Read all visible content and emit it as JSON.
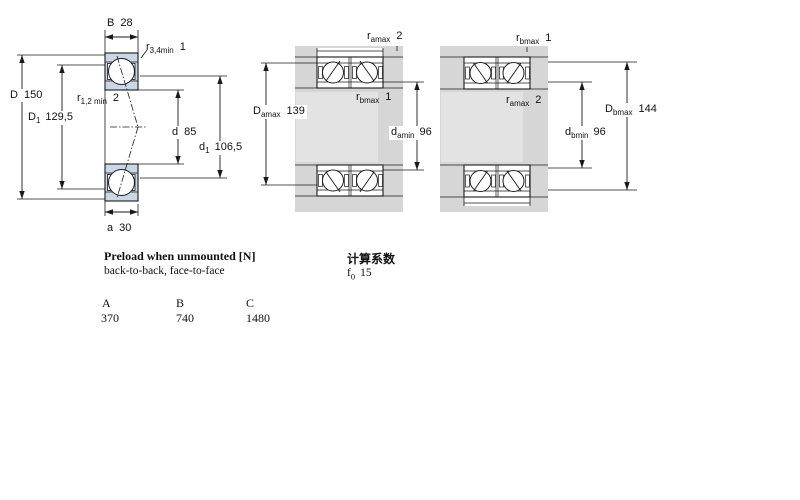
{
  "diagrams": {
    "left": {
      "labels": {
        "B": {
          "sym": "B",
          "val": "28"
        },
        "r34": {
          "sym": "r",
          "sub": "3,4min",
          "val": "1"
        },
        "D": {
          "sym": "D",
          "val": "150"
        },
        "D1": {
          "sym": "D",
          "sub": "1",
          "val": "129,5"
        },
        "r12": {
          "sym": "r",
          "sub": "1,2 min",
          "val": "2"
        },
        "d": {
          "sym": "d",
          "val": "85"
        },
        "d1": {
          "sym": "d",
          "sub": "1",
          "val": "106,5"
        },
        "a": {
          "sym": "a",
          "val": "30"
        }
      }
    },
    "middle": {
      "labels": {
        "ramax": {
          "sym": "r",
          "sub": "amax",
          "val": "2"
        },
        "Damax": {
          "sym": "D",
          "sub": "amax",
          "val": "139"
        },
        "rbmax": {
          "sym": "r",
          "sub": "bmax",
          "val": "1"
        },
        "damin": {
          "sym": "d",
          "sub": "amin",
          "val": "96"
        }
      }
    },
    "right": {
      "labels": {
        "rbmax": {
          "sym": "r",
          "sub": "bmax",
          "val": "1"
        },
        "ramax": {
          "sym": "r",
          "sub": "amax",
          "val": "2"
        },
        "Dbmax": {
          "sym": "D",
          "sub": "bmax",
          "val": "144"
        },
        "dbmin": {
          "sym": "d",
          "sub": "bmin",
          "val": "96"
        }
      }
    }
  },
  "preload": {
    "title": "Preload when unmounted [N]",
    "subtitle": "back-to-back, face-to-face",
    "table": {
      "headers": [
        "A",
        "B",
        "C"
      ],
      "values": [
        "370",
        "740",
        "1480"
      ]
    }
  },
  "calculation": {
    "title": "计算系数",
    "f0": {
      "sym": "f",
      "sub": "0",
      "val": "15"
    }
  },
  "colors": {
    "bearing_ring_blue": "#c9d7e7",
    "steel_gray": "#d6d6d6",
    "steel_gray_light": "#e3e3e3",
    "line_black": "#1a1a1a"
  }
}
